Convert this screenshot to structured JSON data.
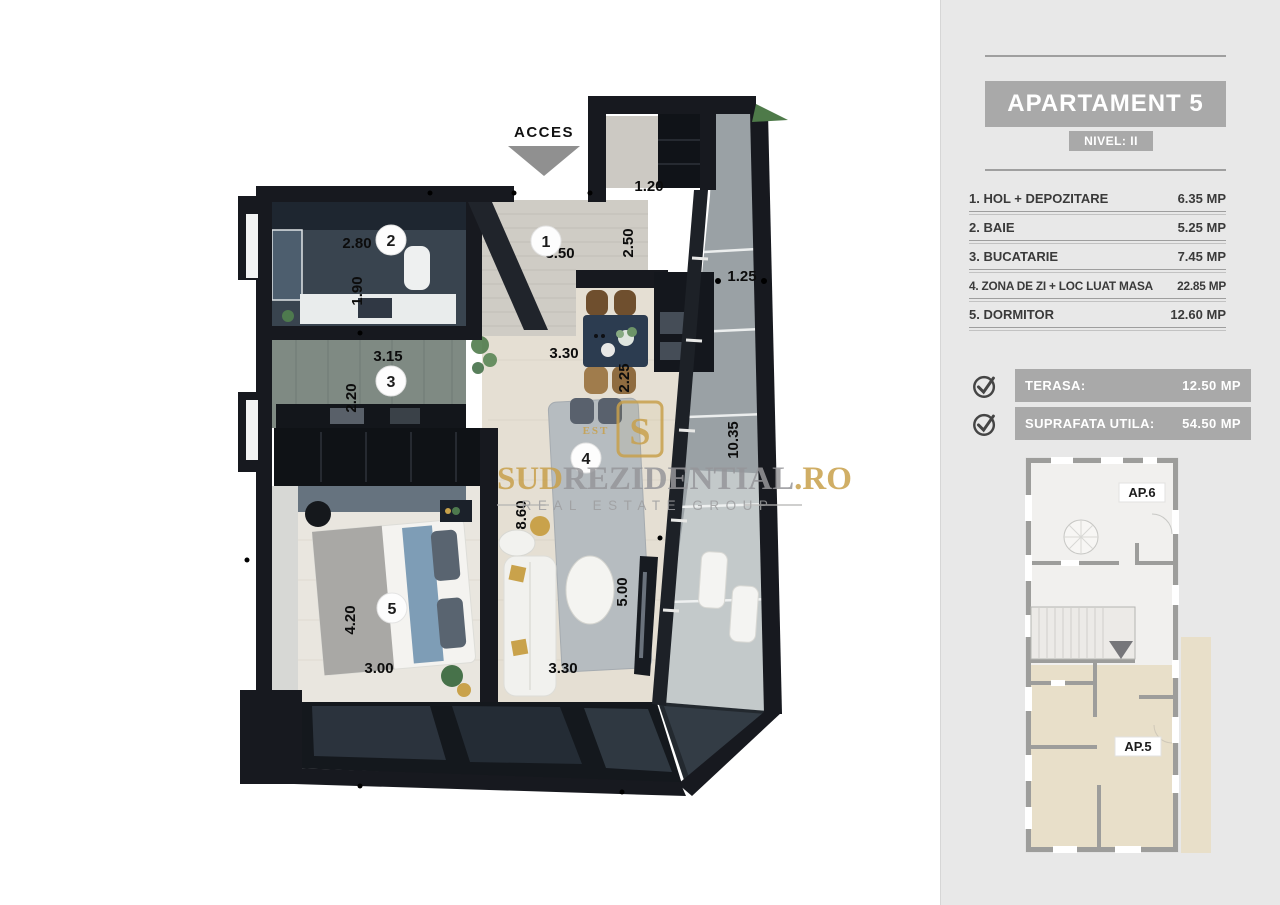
{
  "plan": {
    "acces_label": "ACCES",
    "room_markers": [
      {
        "number": "1"
      },
      {
        "number": "2"
      },
      {
        "number": "3"
      },
      {
        "number": "4"
      },
      {
        "number": "5"
      }
    ],
    "dimensions": [
      "1.20",
      "2.50",
      "3.50",
      "2.80",
      "1.90",
      "1.25",
      "3.15",
      "2.20",
      "3.30",
      "2.25",
      "10.35",
      "8.60",
      "4.20",
      "5.00",
      "3.00",
      "3.30"
    ],
    "watermark": {
      "brand_prefix": "SUD",
      "brand_mid": "REZIDENTIAL",
      "brand_suffix": ".RO",
      "tagline": "REAL ESTATE GROUP",
      "logo_letter": "S",
      "logo_est": "EST"
    },
    "colors": {
      "wall_dark": "#17191f",
      "accent_gold": "#c8a04b"
    }
  },
  "sidebar": {
    "title": "APARTAMENT 5",
    "level": "NIVEL: II",
    "rooms": [
      {
        "label": "1. HOL + DEPOZITARE",
        "area": "6.35 MP"
      },
      {
        "label": "2. BAIE",
        "area": "5.25 MP"
      },
      {
        "label": "3. BUCATARIE",
        "area": "7.45 MP"
      },
      {
        "label": "4. ZONA DE ZI + LOC LUAT MASA",
        "area": "22.85 MP"
      },
      {
        "label": "5. DORMITOR",
        "area": "12.60 MP"
      }
    ],
    "summary": [
      {
        "label": "TERASA:",
        "value": "12.50 MP"
      },
      {
        "label": "SUPRAFATA UTILA:",
        "value": "54.50 MP"
      }
    ],
    "mini_plan": {
      "unit_top": "AP.6",
      "unit_bottom": "AP.5"
    },
    "colors": {
      "panel_gray": "#a9a9a9",
      "highlight_beige": "#e8dfc9"
    }
  }
}
